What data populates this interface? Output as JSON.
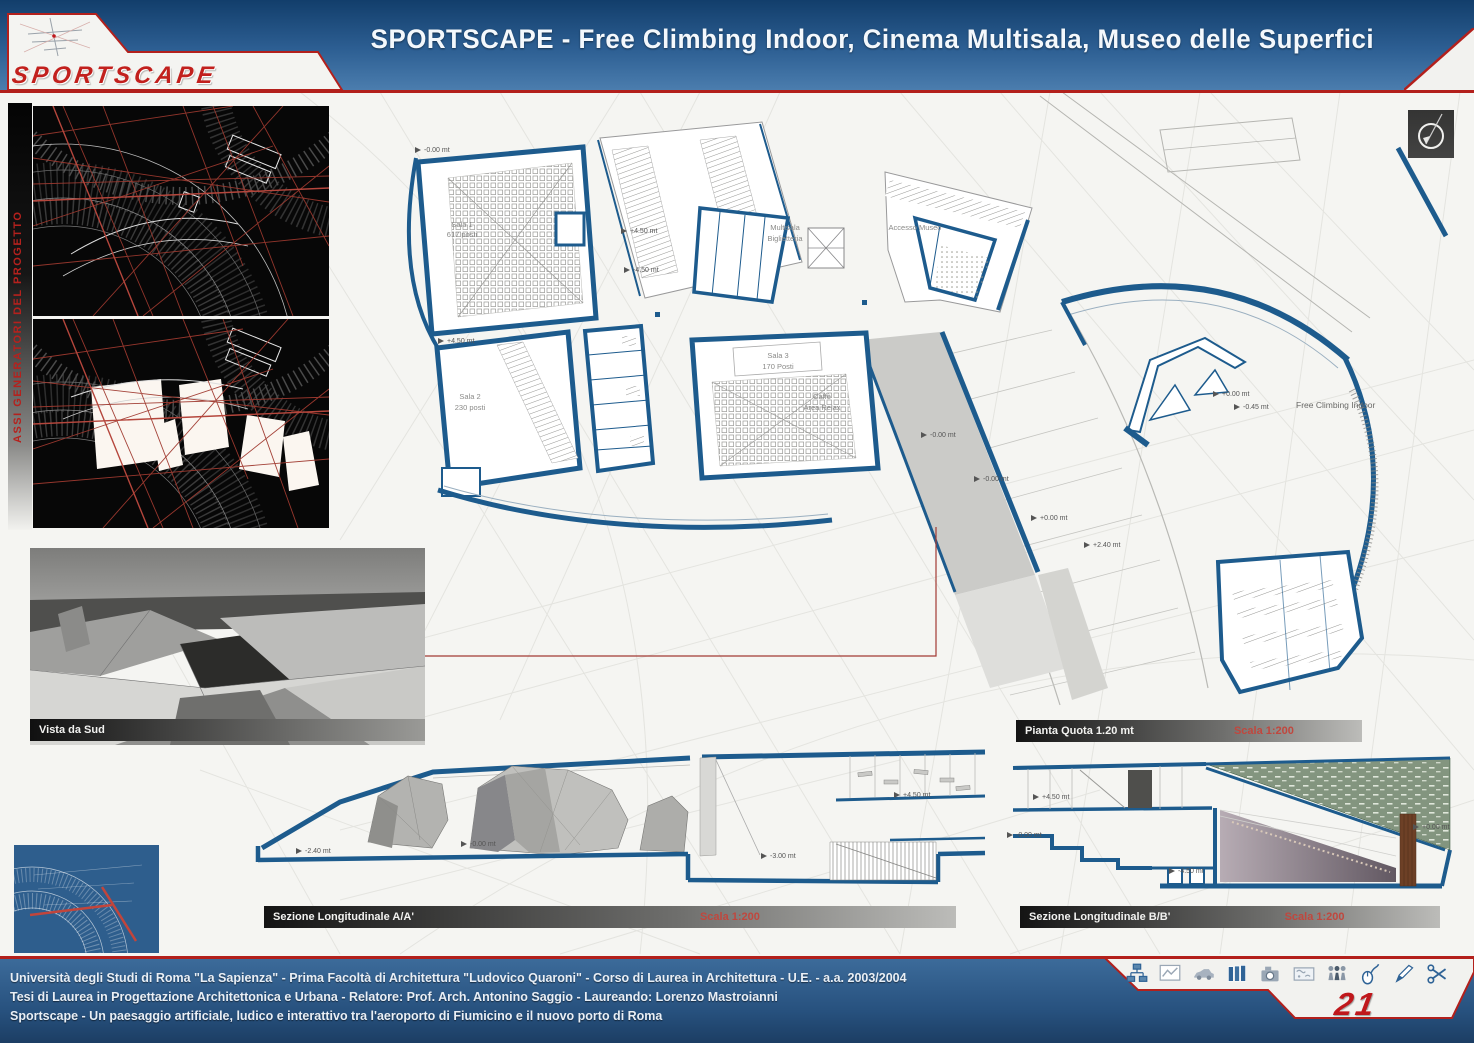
{
  "colors": {
    "accent_red": "#b3201c",
    "header_blue": "#2d5f93",
    "plan_blue": "#1d5b8d",
    "footer_blue": "#27517e"
  },
  "header": {
    "logo": "SPORTSCAPE",
    "title": "SPORTSCAPE - Free Climbing Indoor, Cinema Multisala, Museo delle Superfici"
  },
  "sidebar": {
    "vertical_label": "ASSI GENERATORI DEL PROGETTO"
  },
  "plan": {
    "rooms": {
      "sala1_name": "Sala 1",
      "sala1_seats": "617 posti",
      "sala2_name": "Sala 2",
      "sala2_seats": "230 posti",
      "sala3_name": "Sala 3",
      "sala3_seats": "170 Posti",
      "biglietteria_line1": "Multisala",
      "biglietteria_line2": "Biglietteria",
      "accesso_museo": "Accesso Museo",
      "caffe_line1": "Caffè",
      "caffe_line2": "Area Relax",
      "climbing": "Free Climbing Indoor"
    },
    "markers": [
      "-0.00 mt",
      "+4.50 mt",
      "-4.50 mt",
      "+4.50 mt",
      "-0.00 mt",
      "-0.00 mt",
      "+0.00 mt",
      "+0.00 mt",
      "-0.45 mt",
      "+2.40 mt"
    ],
    "caption": {
      "label": "Pianta Quota 1.20 mt",
      "scale": "Scala 1:200"
    }
  },
  "render_view": {
    "caption": "Vista da Sud"
  },
  "sections": {
    "a": {
      "label": "Sezione Longitudinale A/A'",
      "scale": "Scala 1:200",
      "markers": [
        "-2.40 mt",
        "-0.00 mt",
        "-3.00 mt",
        "+4.50 mt"
      ]
    },
    "b": {
      "label": "Sezione Longitudinale B/B'",
      "scale": "Scala 1:200",
      "markers": [
        "+4.50 mt",
        "-0.00 mt",
        "-4.50 mt",
        "+0.00 mt"
      ]
    }
  },
  "footer": {
    "line1": "Università degli Studi di Roma \"La Sapienza\" - Prima Facoltà di Architettura \"Ludovico Quaroni\" - Corso di Laurea in Architettura - U.E. - a.a. 2003/2004",
    "line2": "Tesi di Laurea in Progettazione Architettonica e Urbana - Relatore: Prof. Arch. Antonino Saggio - Laureando: Lorenzo Mastroianni",
    "line3": "Sportscape - Un paesaggio artificiale, ludico e interattivo tra l'aeroporto di Fiumicino e il nuovo porto di Roma",
    "page_number": "21",
    "icons": [
      "network",
      "chart",
      "car",
      "books",
      "camera",
      "map",
      "people",
      "mouse",
      "pen",
      "scissors"
    ]
  }
}
